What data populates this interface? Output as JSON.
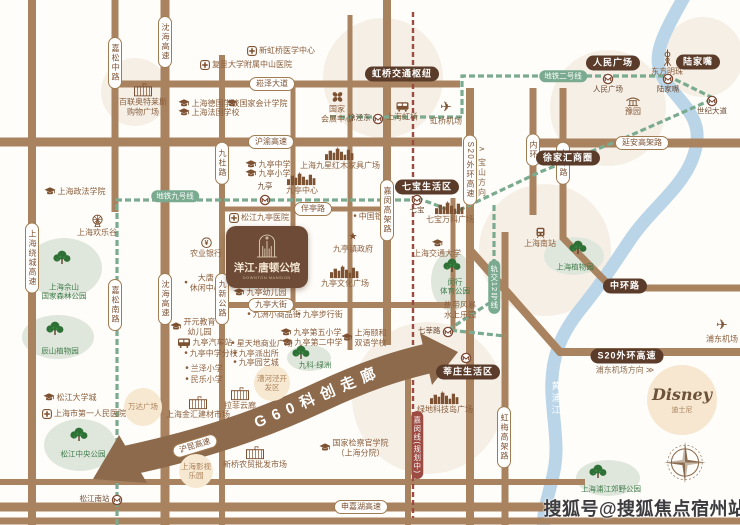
{
  "watermark": "搜狐号@搜狐焦点宿州站",
  "property": {
    "name": "洋江·唐顿公馆",
    "name_en": "DOWNTON MANSION"
  },
  "arrow": {
    "label": "G60科创走廊"
  },
  "disney": {
    "name": "Disney",
    "name_cn": "迪士尼"
  },
  "river": {
    "label": "黄浦江"
  },
  "colors": {
    "road": "#a9835f",
    "metro_green": "#7aab90",
    "planned_red": "#9c4a42",
    "river_blue": "#b6d3e7",
    "dark_badge": "#5b3c2a",
    "park_green": "#3f7b49",
    "poi_brown": "#8a5f3f",
    "arrow_brown": "#8d6a4c"
  },
  "road_badges": [
    {
      "label": "嘉松中路",
      "x": 115,
      "y": 63,
      "v": 1
    },
    {
      "label": "沈海高速",
      "x": 165,
      "y": 42,
      "v": 1
    },
    {
      "label": "崧泽大道",
      "x": 272,
      "y": 84
    },
    {
      "label": "沪渝高速",
      "x": 271,
      "y": 142
    },
    {
      "label": "九杜路",
      "x": 222,
      "y": 163,
      "v": 1
    },
    {
      "label": "上海绕城高速",
      "x": 32,
      "y": 258,
      "v": 1
    },
    {
      "label": "伴亭路",
      "x": 313,
      "y": 209
    },
    {
      "label": "嘉闵高架路",
      "x": 387,
      "y": 210,
      "v": 1
    },
    {
      "label": "内环",
      "x": 533,
      "y": 150,
      "v": 1
    },
    {
      "label": "中环路",
      "x": 563,
      "y": 163,
      "v": 1
    },
    {
      "label": "S20外环高速",
      "x": 470,
      "y": 170,
      "v": 1
    },
    {
      "label": "延安高架路",
      "x": 642,
      "y": 143
    },
    {
      "label": "沈海高速",
      "x": 165,
      "y": 299,
      "v": 1
    },
    {
      "label": "嘉松南路",
      "x": 115,
      "y": 305,
      "v": 1
    },
    {
      "label": "九新公路",
      "x": 222,
      "y": 299,
      "v": 1
    },
    {
      "label": "九亭大街",
      "x": 271,
      "y": 305
    },
    {
      "label": "虹梅高架路",
      "x": 504,
      "y": 437,
      "v": 1
    },
    {
      "label": "申嘉湖高速",
      "x": 361,
      "y": 507
    },
    {
      "label": "沪昆高速",
      "x": 195,
      "y": 446,
      "r": -17
    }
  ],
  "zone_badges": [
    {
      "label": "虹桥交通枢纽",
      "x": 402,
      "y": 74
    },
    {
      "label": "人民广场",
      "x": 613,
      "y": 63
    },
    {
      "label": "陆家嘴",
      "x": 698,
      "y": 62
    },
    {
      "label": "徐家汇商圈",
      "x": 568,
      "y": 158
    },
    {
      "label": "七宝生活区",
      "x": 427,
      "y": 187
    },
    {
      "label": "莘庄生活区",
      "x": 468,
      "y": 372
    },
    {
      "label": "中环路",
      "x": 625,
      "y": 286
    },
    {
      "label": "S20外环高速",
      "x": 627,
      "y": 356
    }
  ],
  "metro_badges": [
    {
      "label": "地铁九号线",
      "x": 175,
      "y": 196
    },
    {
      "label": "地铁二号线",
      "x": 563,
      "y": 76
    },
    {
      "label": "轨交12号线",
      "x": 494,
      "y": 287,
      "v": 1
    }
  ],
  "planned_badge": {
    "label": "嘉闵线(规划中)",
    "x": 417,
    "y": 445
  },
  "direction_labels": [
    {
      "label": "∧ 宝山方向",
      "x": 482,
      "y": 172,
      "v": 1
    },
    {
      "label": "浦东机场方向 ≫",
      "x": 625,
      "y": 370
    }
  ],
  "stations": [
    {
      "label": "九亭",
      "x": 265,
      "y": 198,
      "lp": "t"
    },
    {
      "label": "七宝",
      "x": 417,
      "y": 198,
      "lp": "b"
    },
    {
      "label": "徐泾东",
      "x": 378,
      "y": 117,
      "lp": "l"
    },
    {
      "label": "人民广场",
      "x": 608,
      "y": 77,
      "lp": "b"
    },
    {
      "label": "陆家嘴",
      "x": 668,
      "y": 77,
      "lp": "b"
    },
    {
      "label": "世纪大道",
      "x": 712,
      "y": 99,
      "lp": "b"
    },
    {
      "label": "七莘路",
      "x": 448,
      "y": 330,
      "lp": "l"
    },
    {
      "label": "",
      "x": 466,
      "y": 356,
      "lp": "b"
    },
    {
      "label": "松江南站",
      "x": 117,
      "y": 498,
      "lp": "l"
    }
  ],
  "pois": [
    {
      "icon": "school",
      "label": "上海德国学校",
      "x": 209,
      "y": 104
    },
    {
      "icon": "school",
      "label": "上海法国学校",
      "x": 209,
      "y": 113
    },
    {
      "icon": "school",
      "label": "国家会计学院",
      "x": 257,
      "y": 104
    },
    {
      "icon": "hospital",
      "label": "新虹桥医学中心",
      "x": 281,
      "y": 51
    },
    {
      "icon": "hospital",
      "label": "复旦大学附属中山医院",
      "x": 246,
      "y": 65
    },
    {
      "icon": "building",
      "lines": [
        "百联奥特莱斯",
        "购物广场"
      ],
      "x": 143,
      "y": 100,
      "it": 1
    },
    {
      "icon": "clover",
      "lines": [
        "国家",
        "会展中心"
      ],
      "x": 337,
      "y": 107,
      "it": 1
    },
    {
      "icon": "bus",
      "label": "上海虹桥",
      "x": 402,
      "y": 112,
      "it": 1
    },
    {
      "icon": "plane",
      "label": "虹桥机场",
      "x": 446,
      "y": 112,
      "it": 1
    },
    {
      "icon": "tower",
      "label": "东方明珠",
      "x": 667,
      "y": 63,
      "it": 1
    },
    {
      "icon": "pavilion",
      "label": "豫园",
      "x": 633,
      "y": 107,
      "it": 1
    },
    {
      "icon": "school",
      "label": "九亭中学",
      "x": 268,
      "y": 165
    },
    {
      "icon": "school",
      "label": "九亭小学",
      "x": 268,
      "y": 174
    },
    {
      "icon": "hospital",
      "label": "松江九亭医院",
      "x": 259,
      "y": 218
    },
    {
      "icon": "dot",
      "label": "中国银行",
      "x": 372,
      "y": 217
    },
    {
      "icon": "star",
      "label": "九亭镇政府",
      "x": 353,
      "y": 243,
      "it": 1
    },
    {
      "icon": "bank",
      "label": "农业银行",
      "x": 206,
      "y": 248,
      "it": 1
    },
    {
      "icon": "skyline",
      "label": "九亭中心",
      "x": 302,
      "y": 184,
      "it": 1
    },
    {
      "icon": "skyline",
      "label": "上海九星红木家具广场",
      "x": 340,
      "y": 159,
      "it": 1
    },
    {
      "icon": "skyline",
      "label": "九亭文化广场",
      "x": 345,
      "y": 277,
      "it": 1
    },
    {
      "icon": "skyline",
      "label": "七宝万科广场",
      "x": 450,
      "y": 213,
      "it": 1
    },
    {
      "icon": "school",
      "label": "九亭幼儿园",
      "x": 260,
      "y": 293
    },
    {
      "icon": "dot",
      "label": "九洲小商品街",
      "x": 274,
      "y": 315
    },
    {
      "icon": "dot",
      "label": "九亭步行街",
      "x": 320,
      "y": 315
    },
    {
      "icon": "dot",
      "lines": [
        "大唐",
        "休闲中心"
      ],
      "x": 203,
      "y": 283
    },
    {
      "icon": "school",
      "lines": [
        "开元教育",
        "幼儿园"
      ],
      "x": 193,
      "y": 327
    },
    {
      "icon": "school",
      "label": "九亭第五小学",
      "x": 311,
      "y": 333
    },
    {
      "icon": "school",
      "label": "九亭第二中学",
      "x": 312,
      "y": 343
    },
    {
      "icon": "school",
      "lines": [
        "上海颐和",
        "双语学校"
      ],
      "x": 364,
      "y": 338
    },
    {
      "icon": "bus",
      "label": "九亭汽车站",
      "x": 205,
      "y": 343
    },
    {
      "icon": "dot",
      "label": "九亭中学分校",
      "x": 211,
      "y": 354
    },
    {
      "icon": "dot",
      "label": "星天地商业广场",
      "x": 262,
      "y": 344
    },
    {
      "icon": "dot",
      "label": "九亭派出所",
      "x": 256,
      "y": 354
    },
    {
      "icon": "dot",
      "label": "九亭园艺城",
      "x": 256,
      "y": 363
    },
    {
      "icon": "dot",
      "label": "兰泽小学",
      "x": 204,
      "y": 369
    },
    {
      "icon": "dot",
      "label": "民乐小学",
      "x": 204,
      "y": 380
    },
    {
      "icon": "building",
      "label": "上海金汇建材市场",
      "x": 198,
      "y": 408,
      "it": 1
    },
    {
      "icon": "building",
      "label": "拉菲云廊",
      "x": 240,
      "y": 399,
      "it": 1
    },
    {
      "icon": "building",
      "label": "新桥农贸批发市场",
      "x": 255,
      "y": 458,
      "it": 1
    },
    {
      "icon": "school",
      "lines": [
        "国家检察官学院",
        "（上海分院）"
      ],
      "x": 354,
      "y": 448
    },
    {
      "icon": "skyline",
      "label": "绿地科技岛广场",
      "x": 445,
      "y": 403,
      "it": 1
    },
    {
      "lines": [
        "热带风暴",
        "水上乐园"
      ],
      "x": 460,
      "y": 310
    },
    {
      "icon": "school",
      "label": "上海交通大学",
      "x": 437,
      "y": 249,
      "it": 1
    },
    {
      "icon": "train",
      "label": "上海南站",
      "x": 540,
      "y": 238,
      "it": 1
    },
    {
      "icon": "plane",
      "label": "浦东机场",
      "x": 722,
      "y": 330,
      "it": 1
    },
    {
      "icon": "school",
      "label": "上海政法学院",
      "x": 75,
      "y": 192
    },
    {
      "icon": "wheel",
      "label": "上海欢乐谷",
      "x": 97,
      "y": 226,
      "it": 1
    },
    {
      "icon": "school",
      "label": "松江大学城",
      "x": 70,
      "y": 398
    },
    {
      "icon": "hospital",
      "label": "上海市第一人民医院",
      "x": 84,
      "y": 414
    }
  ],
  "parks": [
    {
      "x": 64,
      "y": 268,
      "rx": 38,
      "ry": 30,
      "gx": 62,
      "gy": 260,
      "tx": 64,
      "ty": 292,
      "lines": [
        "上海佘山",
        "国家森林公园"
      ]
    },
    {
      "x": 58,
      "y": 337,
      "rx": 36,
      "ry": 22,
      "gx": 55,
      "gy": 331,
      "tx": 60,
      "ty": 351,
      "lines": [
        "辰山植物园"
      ]
    },
    {
      "x": 80,
      "y": 445,
      "rx": 36,
      "ry": 26,
      "gx": 79,
      "gy": 437,
      "tx": 83,
      "ty": 454,
      "lines": [
        "松江中央公园"
      ]
    },
    {
      "x": 452,
      "y": 281,
      "rx": 21,
      "ry": 30,
      "gx": 452,
      "gy": 268,
      "tx": 455,
      "ty": 287,
      "lines": [
        "闵行",
        "体育公园"
      ]
    },
    {
      "x": 574,
      "y": 256,
      "rx": 30,
      "ry": 19,
      "gx": 578,
      "gy": 250,
      "tx": 575,
      "ty": 267,
      "lines": [
        "上海植物园"
      ]
    },
    {
      "x": 608,
      "y": 478,
      "rx": 32,
      "ry": 18,
      "gx": 598,
      "gy": 474,
      "tx": 611,
      "ty": 489,
      "lines": [
        "上海浦江郊野公园"
      ]
    },
    {
      "x": 309,
      "y": 358,
      "rx": 22,
      "ry": 13,
      "gx": 301,
      "gy": 355,
      "tx": 315,
      "ty": 365,
      "lines": [
        "九科·绿洲"
      ]
    }
  ],
  "plazas": [
    {
      "label": "万达广场",
      "x": 143,
      "y": 407,
      "r": 19
    },
    {
      "label": "漕河泾开发区",
      "x": 272,
      "y": 383,
      "r": 18
    },
    {
      "label": "上海影视乐园",
      "x": 196,
      "y": 471,
      "r": 17
    }
  ],
  "bg_circles": [
    [
      383,
      78,
      60
    ],
    [
      608,
      108,
      58
    ],
    [
      703,
      57,
      40
    ],
    [
      545,
      250,
      66
    ],
    [
      428,
      398,
      76
    ],
    [
      135,
      92,
      34
    ]
  ]
}
